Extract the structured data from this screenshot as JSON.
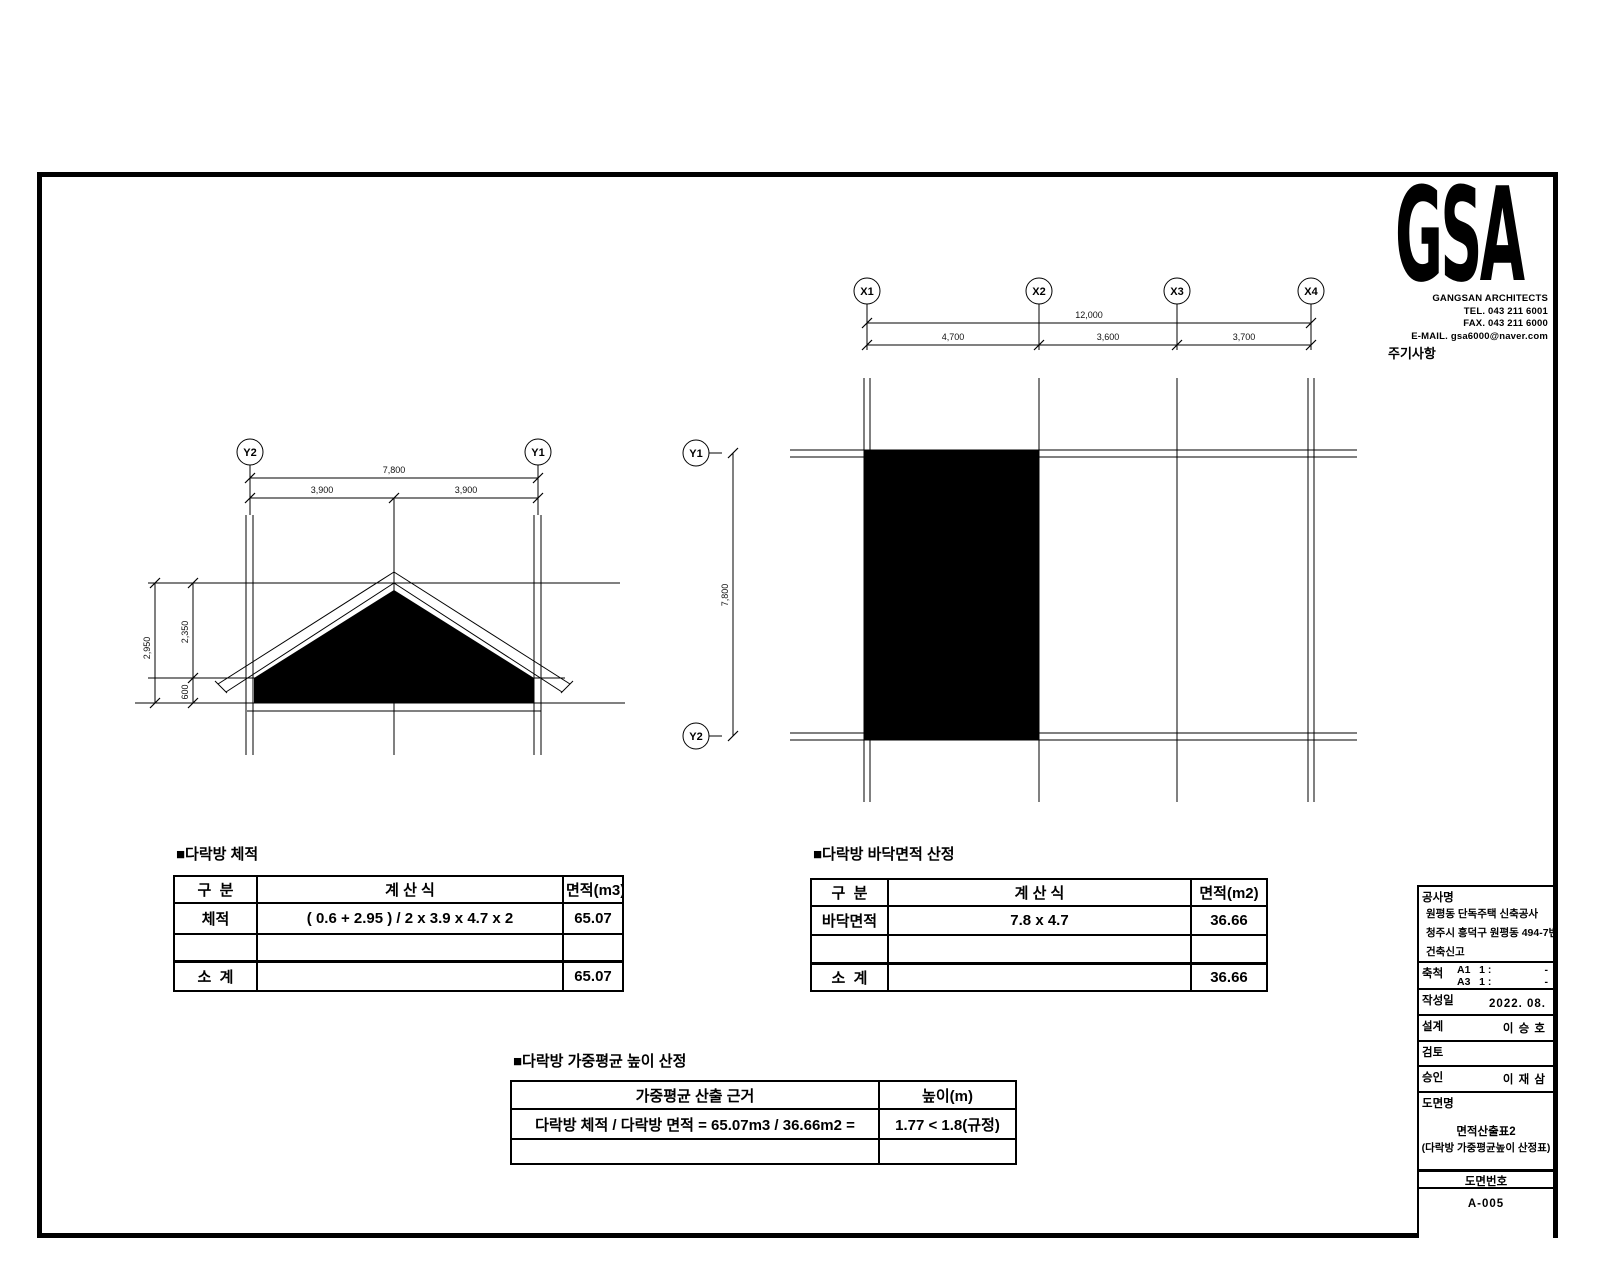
{
  "logo": {
    "text": "GSA",
    "firm": "GANGSAN ARCHITECTS",
    "tel": "TEL. 043 211 6001",
    "fax": "FAX. 043 211 6000",
    "email": "E-MAIL. gsa6000@naver.com"
  },
  "notes_label": "주기사항",
  "elevation": {
    "marker_left": "Y2",
    "marker_right": "Y1",
    "dims": {
      "total": "7,800",
      "seg1": "3,900",
      "seg2": "3,900",
      "height_total": "2,950",
      "height_upper": "2,350",
      "height_lower": "600"
    }
  },
  "plan": {
    "markers": {
      "x1": "X1",
      "x2": "X2",
      "x3": "X3",
      "x4": "X4",
      "y1": "Y1",
      "y2": "Y2"
    },
    "dims": {
      "total": "12,000",
      "seg1": "4,700",
      "seg2": "3,600",
      "seg3": "3,700",
      "vertical": "7,800"
    }
  },
  "tables": {
    "volume": {
      "title": "■다락방 체적",
      "headers": [
        "구  분",
        "계 산 식",
        "면적(m3)"
      ],
      "rows": [
        [
          "체적",
          "( 0.6 + 2.95 ) / 2 x 3.9 x 4.7 x 2",
          "65.07"
        ],
        [
          "",
          "",
          ""
        ],
        [
          "소  계",
          "",
          "65.07"
        ]
      ]
    },
    "floor_area": {
      "title": "■다락방 바닥면적 산정",
      "headers": [
        "구  분",
        "계 산 식",
        "면적(m2)"
      ],
      "rows": [
        [
          "바닥면적",
          "7.8 x 4.7",
          "36.66"
        ],
        [
          "",
          "",
          ""
        ],
        [
          "소  계",
          "",
          "36.66"
        ]
      ]
    },
    "avg_height": {
      "title": "■다락방 가중평균 높이 산정",
      "headers": [
        "가중평균 산출 근거",
        "높이(m)"
      ],
      "rows": [
        [
          "다락방 체적 / 다락방 면적 = 65.07m3 / 36.66m2 =",
          "1.77 < 1.8(규정)"
        ],
        [
          "",
          ""
        ]
      ]
    }
  },
  "title_block": {
    "project_label": "공사명",
    "project_lines": [
      "원평동 단독주택 신축공사",
      "청주시 흥덕구 원평동 494-7번지",
      "건축신고"
    ],
    "scale_label": "축척",
    "scale_lines": [
      {
        "left": "A1   1 :",
        "right": "-"
      },
      {
        "left": "A3   1 :",
        "right": "-"
      }
    ],
    "date_label": "작성일",
    "date_value": "2022. 08.",
    "design_label": "설계",
    "design_value": "이 승 호",
    "review_label": "검토",
    "review_value": "",
    "approval_label": "승인",
    "approval_value": "이 재 삼",
    "drawing_title_label": "도면명",
    "drawing_title_line1": "면적산출표2",
    "drawing_title_line2": "(다락방 가중평균높이 산정표)",
    "drawing_no_label": "도면번호",
    "drawing_no_value": "A-005"
  }
}
